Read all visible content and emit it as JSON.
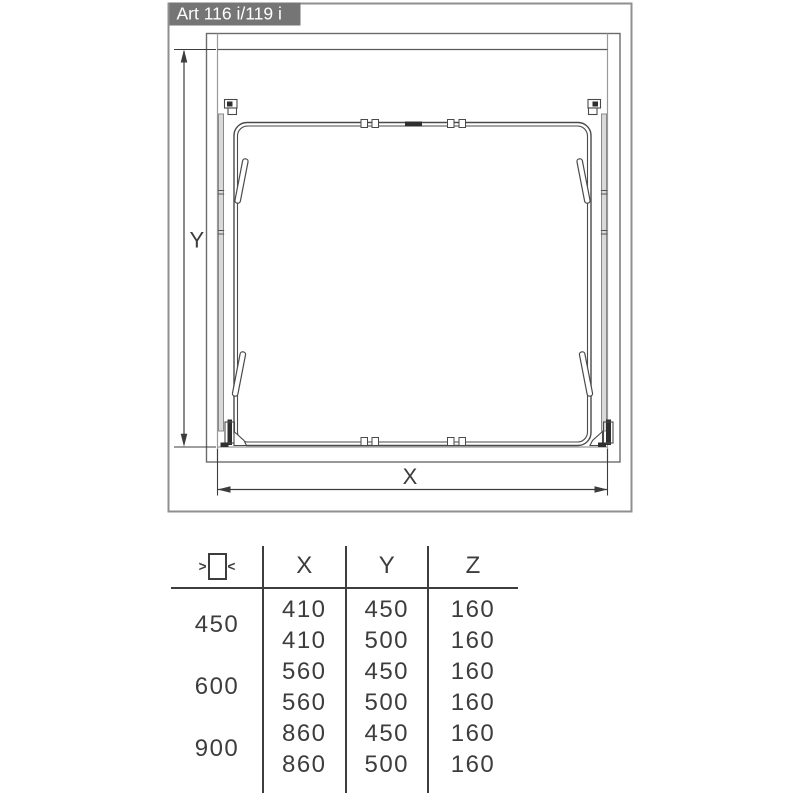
{
  "title": "Art 116 i/119 i",
  "diagram": {
    "y_dim_label": "Y",
    "x_dim_label": "X"
  },
  "table": {
    "icon": {
      "left_arrow": ">",
      "right_arrow": "<"
    },
    "headers": {
      "x": "X",
      "y": "Y",
      "z": "Z"
    },
    "groups": [
      {
        "width": "450",
        "rows": [
          {
            "x": "410",
            "y": "450",
            "z": "160"
          },
          {
            "x": "410",
            "y": "500",
            "z": "160"
          }
        ]
      },
      {
        "width": "600",
        "rows": [
          {
            "x": "560",
            "y": "450",
            "z": "160"
          },
          {
            "x": "560",
            "y": "500",
            "z": "160"
          }
        ]
      },
      {
        "width": "900",
        "rows": [
          {
            "x": "860",
            "y": "450",
            "z": "160"
          },
          {
            "x": "860",
            "y": "500",
            "z": "160"
          }
        ]
      }
    ]
  },
  "colors": {
    "title_bg": "#757575",
    "title_text": "#ffffff",
    "line_dark": "#3c3c3c",
    "line_gray": "#8f8f8f"
  }
}
